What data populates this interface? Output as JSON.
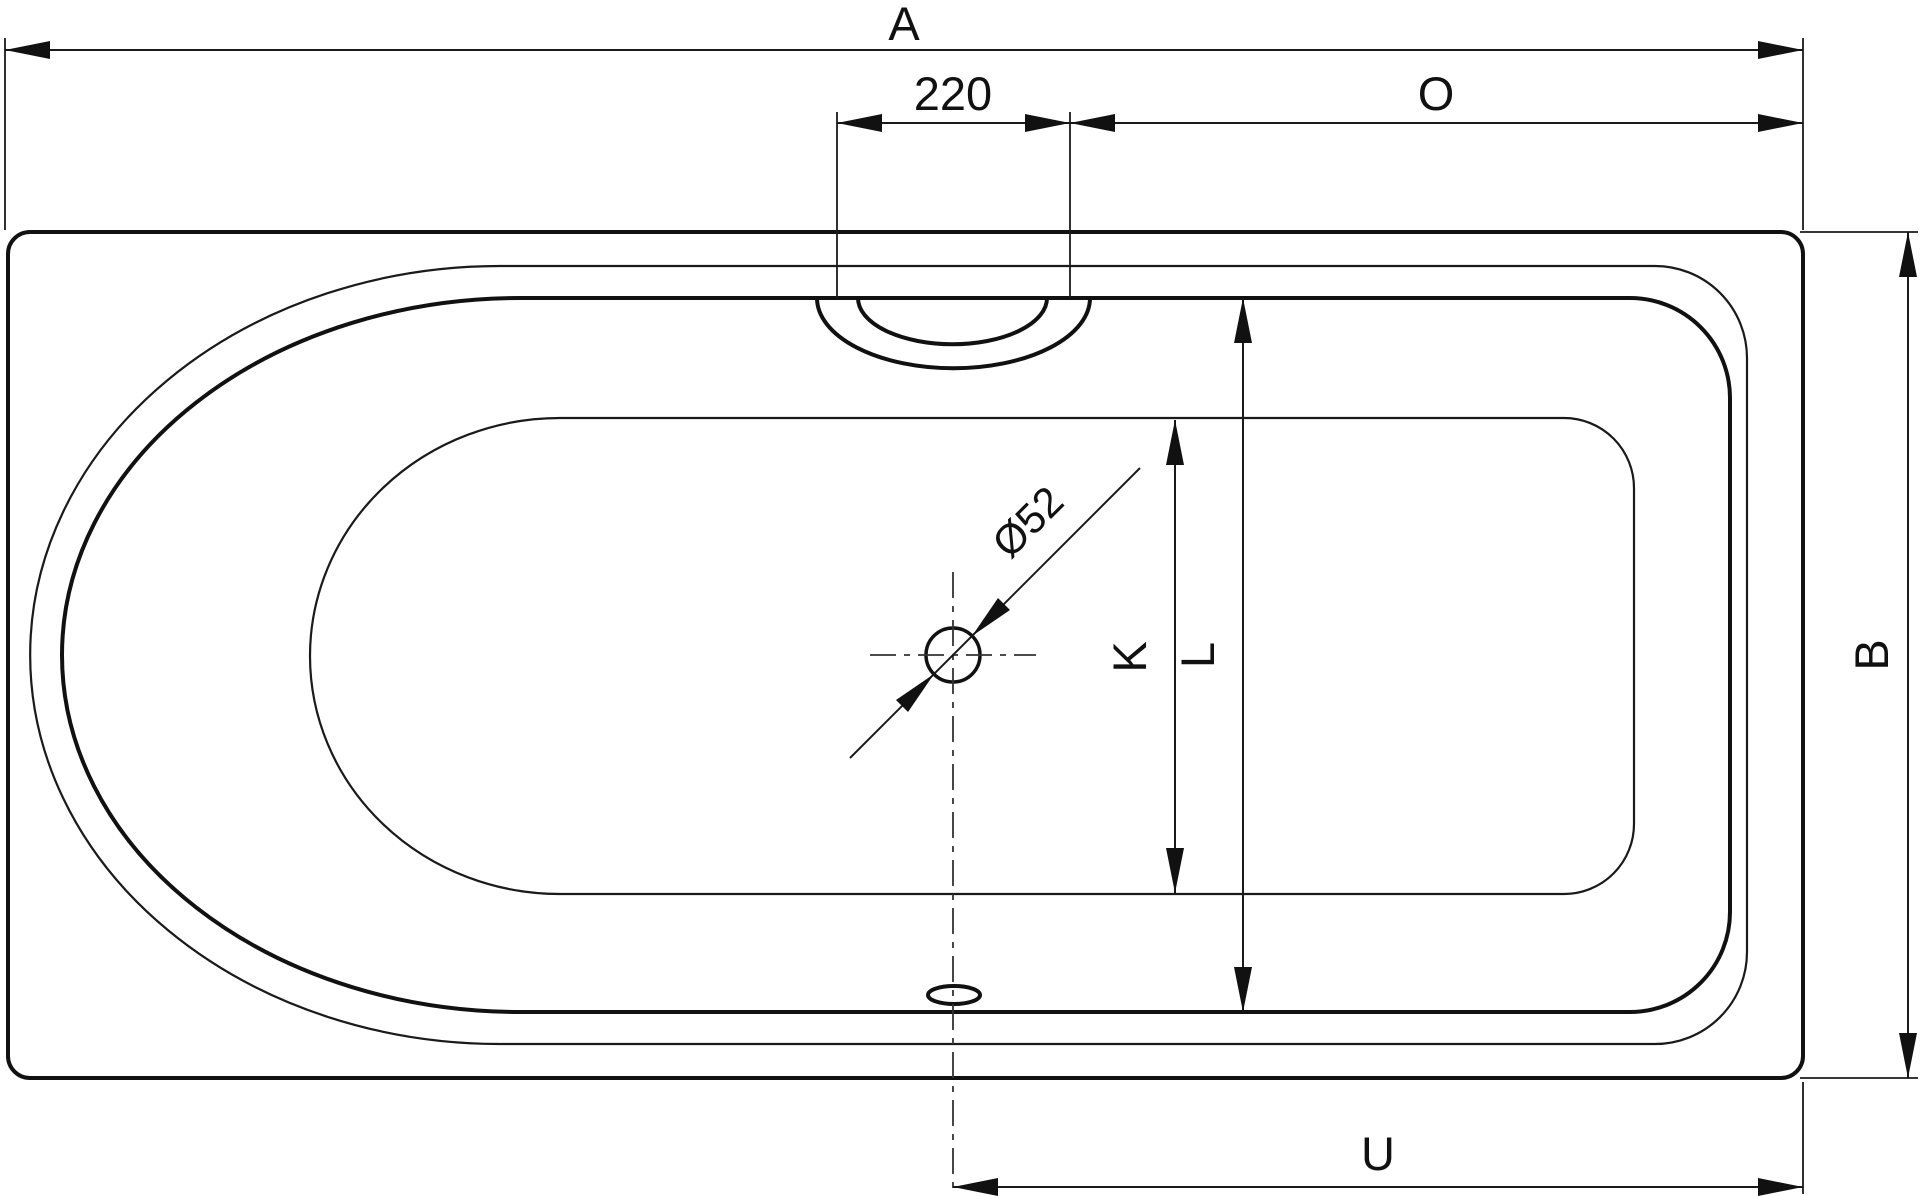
{
  "drawing": {
    "subject": "bathtub-top-view-technical-drawing",
    "background_color": "#ffffff",
    "line_color": "#111111",
    "dimensions": {
      "overall_length": {
        "label": "A",
        "orientation": "horizontal"
      },
      "overflow_offset": {
        "label": "220",
        "orientation": "horizontal"
      },
      "tap_edge_distance": {
        "label": "O",
        "orientation": "horizontal"
      },
      "overall_width": {
        "label": "B",
        "orientation": "vertical"
      },
      "inner_floor_width": {
        "label": "K",
        "orientation": "vertical"
      },
      "inner_rim_width": {
        "label": "L",
        "orientation": "vertical"
      },
      "drain_edge_distance": {
        "label": "U",
        "orientation": "horizontal"
      },
      "drain_diameter": {
        "label": "Ø52",
        "orientation": "diagonal"
      }
    }
  }
}
